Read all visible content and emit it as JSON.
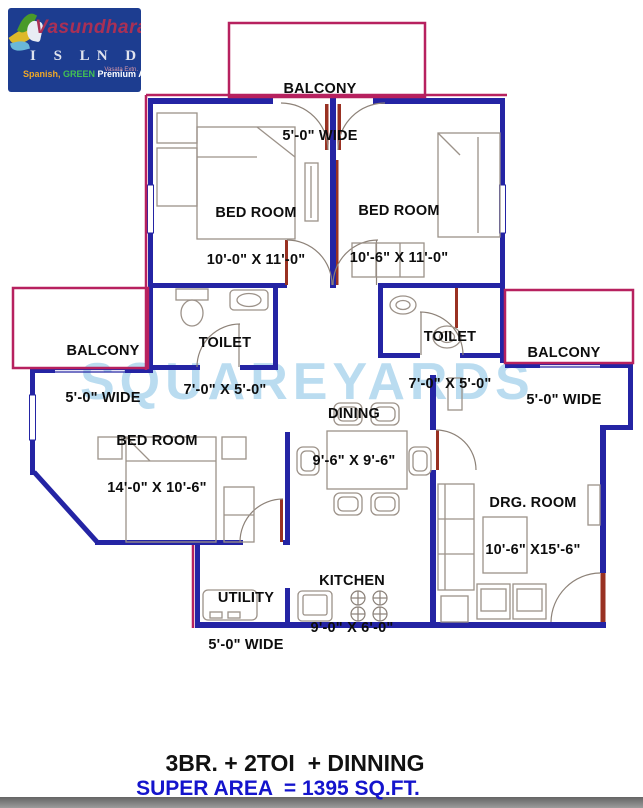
{
  "logo": {
    "brand": "Vasundhara",
    "island_left": "I S L",
    "island_right": "N D",
    "small_text": "Vasata Extn.",
    "tagline_1": "Spanish,",
    "tagline_2": " GREEN ",
    "tagline_3": "Premium Apartment"
  },
  "watermark": "SQUAREYARDS",
  "rooms": {
    "balcony_top": {
      "name": "BALCONY",
      "dims": "5'-0\" WIDE"
    },
    "bedroom_1": {
      "name": "BED ROOM",
      "dims": "10'-0\" X 11'-0\""
    },
    "bedroom_2": {
      "name": "BED ROOM",
      "dims": "10'-6\" X 11'-0\""
    },
    "toilet_1": {
      "name": "TOILET",
      "dims": "7'-0\" X 5'-0\""
    },
    "toilet_2": {
      "name": "TOILET",
      "dims": "7'-0\" X 5'-0\""
    },
    "balcony_left": {
      "name": "BALCONY",
      "dims": "5'-0\" WIDE"
    },
    "balcony_right": {
      "name": "BALCONY",
      "dims": "5'-0\" WIDE"
    },
    "dining": {
      "name": "DINING",
      "dims": "9'-6\" X 9'-6\""
    },
    "bedroom_3": {
      "name": "BED ROOM",
      "dims": "14'-0\" X 10'-6\""
    },
    "drawing_room": {
      "name": "DRG. ROOM",
      "dims": "10'-6\" X15'-6\""
    },
    "kitchen": {
      "name": "KITCHEN",
      "dims": "9'-0\" X 6'-0\""
    },
    "utility": {
      "name": "UTILITY",
      "dims": "5'-0\" WIDE"
    }
  },
  "footer": {
    "configuration": "3BR. + 2TOI  + DINNING",
    "super_area": "SUPER AREA  = 1395 SQ.FT."
  },
  "colors": {
    "wall": "#2424a4",
    "balcony_wall": "#b7215f",
    "door_accent": "#993122",
    "watermark": "#badcf0",
    "super_area_text": "#1414cc",
    "logo_background": "#1d3d90"
  }
}
